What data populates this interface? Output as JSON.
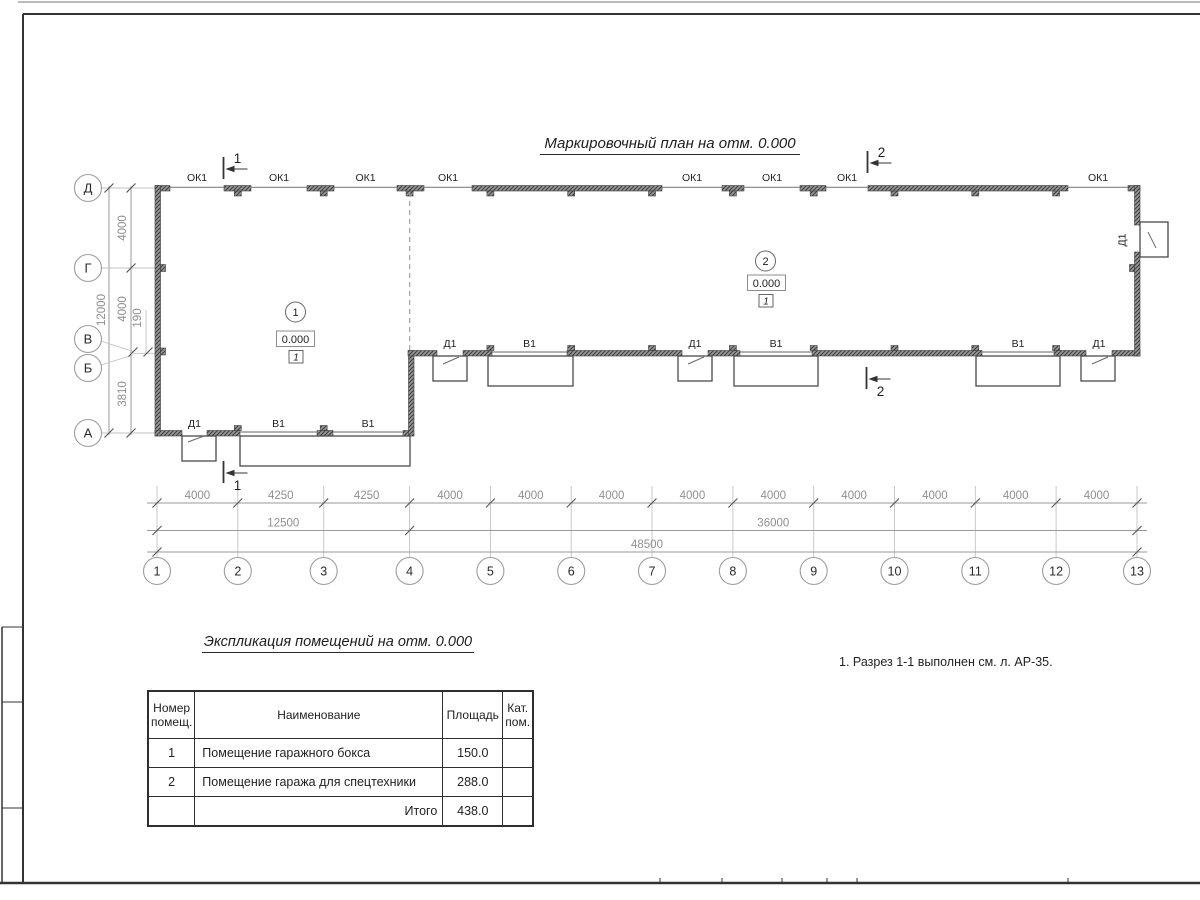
{
  "colors": {
    "line": "#333333",
    "dim_line": "#9a9a9a",
    "dim_text": "#8f8f8f",
    "wall_hatch_dark": "#3d3d3d",
    "wall_hatch_light": "#979797",
    "background": "#ffffff"
  },
  "plan": {
    "title": "Маркировочный план на отм. 0.000",
    "window_mark": "ОК1",
    "door_mark": "Д1",
    "gate_mark": "В1",
    "rooms": [
      {
        "number": "1",
        "elevation": "0.000",
        "floor_type": "1"
      },
      {
        "number": "2",
        "elevation": "0.000",
        "floor_type": "1"
      }
    ],
    "section_marks": [
      "1",
      "2"
    ]
  },
  "axes": {
    "columns": [
      "1",
      "2",
      "3",
      "4",
      "5",
      "6",
      "7",
      "8",
      "9",
      "10",
      "11",
      "12",
      "13"
    ],
    "rows": [
      "А",
      "Б",
      "В",
      "Г",
      "Д"
    ]
  },
  "dimensions": {
    "bottom_segments": [
      "4000",
      "4250",
      "4250",
      "4000",
      "4000",
      "4000",
      "4000",
      "4000",
      "4000",
      "4000",
      "4000",
      "4000"
    ],
    "bottom_totals": [
      "12500",
      "36000"
    ],
    "bottom_overall": "48500",
    "left_segments": [
      "4000",
      "4000",
      "190",
      "3810"
    ],
    "left_overall": "12000"
  },
  "table": {
    "title": "Экспликация помещений на отм. 0.000",
    "headers": [
      "Номер помещ.",
      "Наименование",
      "Площадь",
      "Кат. пом."
    ],
    "rows": [
      {
        "num": "1",
        "name": "Помещение гаражного бокса",
        "area": "150.0",
        "cat": ""
      },
      {
        "num": "2",
        "name": "Помещение гаража для спецтехники",
        "area": "288.0",
        "cat": ""
      }
    ],
    "total_label": "Итого",
    "total_area": "438.0"
  },
  "note": "1. Разрез 1-1 выполнен см. л. АР-35."
}
